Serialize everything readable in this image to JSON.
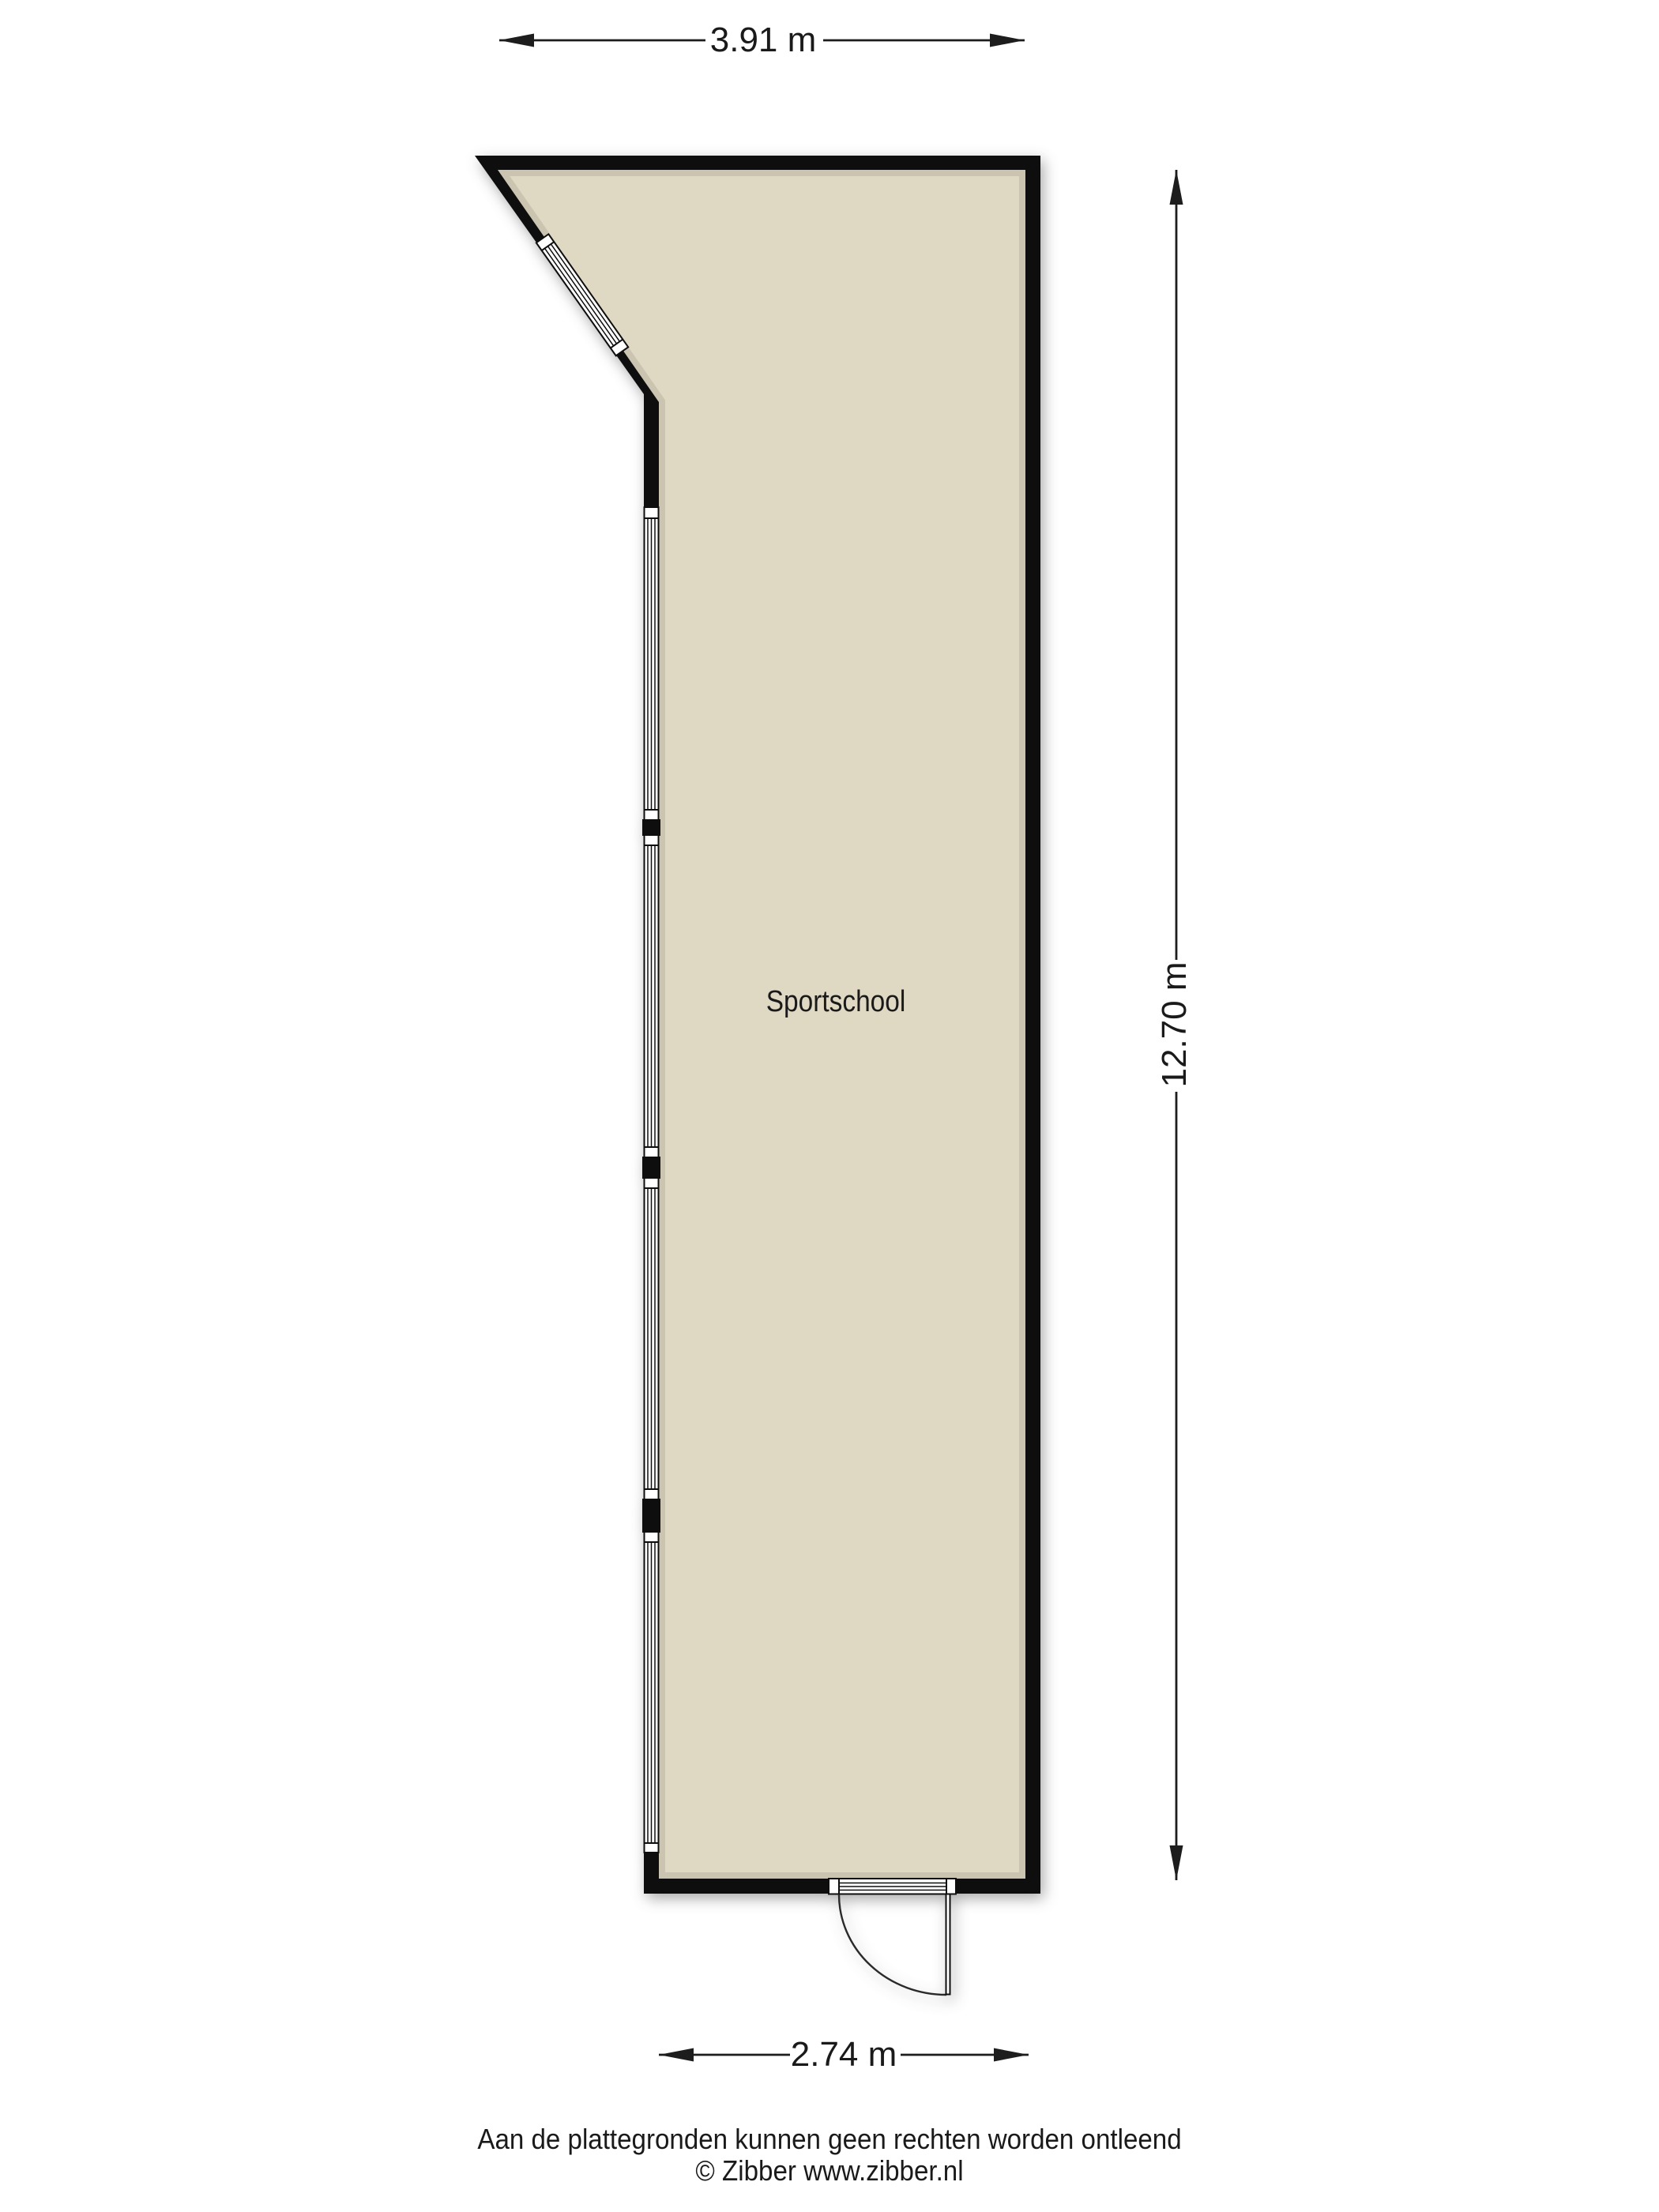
{
  "floorplan": {
    "room_label": "Sportschool",
    "dimensions": {
      "top": "3.91 m",
      "right": "12.70 m",
      "bottom": "2.74 m"
    }
  },
  "footer": {
    "disclaimer": "Aan de plattegronden kunnen geen rechten worden ontleend",
    "copyright": "© Zibber www.zibber.nl"
  },
  "colors": {
    "background": "#ffffff",
    "floor": "#dfd8c2",
    "wall": "#0e0e0e",
    "line": "#1d1d1d",
    "text": "#1a1a1a"
  }
}
